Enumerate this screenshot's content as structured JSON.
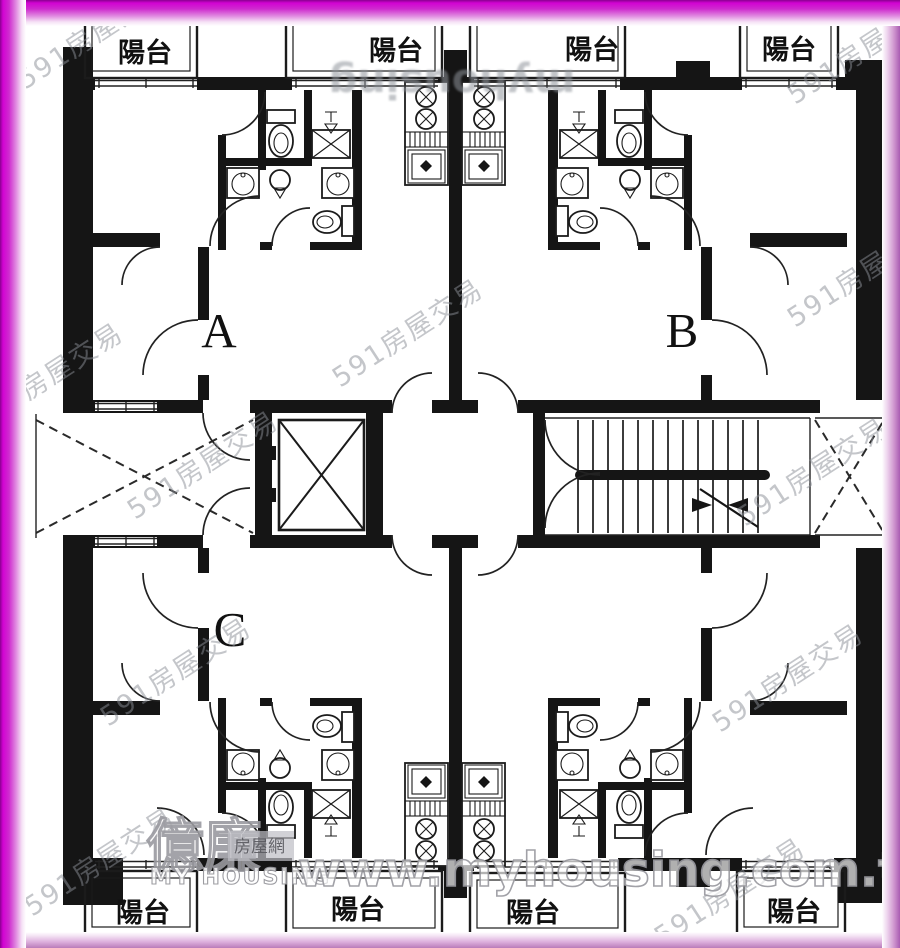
{
  "title": "apartment floor plan",
  "plan": {
    "balcony_label": "陽台",
    "units": {
      "a": "A",
      "b": "B",
      "c": "C"
    }
  },
  "watermarks": {
    "diagonal": "591房屋交易",
    "flipped_top": "myhousing",
    "logo_cn": "億廉",
    "logo_badge": "房屋網",
    "logo_en": "MY HOUSING",
    "url": "www.myhousing.com.tw"
  },
  "colors": {
    "border_magenta": "#d203d2",
    "border_pink": "#eed6ee",
    "wall_black": "#151515",
    "watermark_gray": "#8b8f97"
  }
}
